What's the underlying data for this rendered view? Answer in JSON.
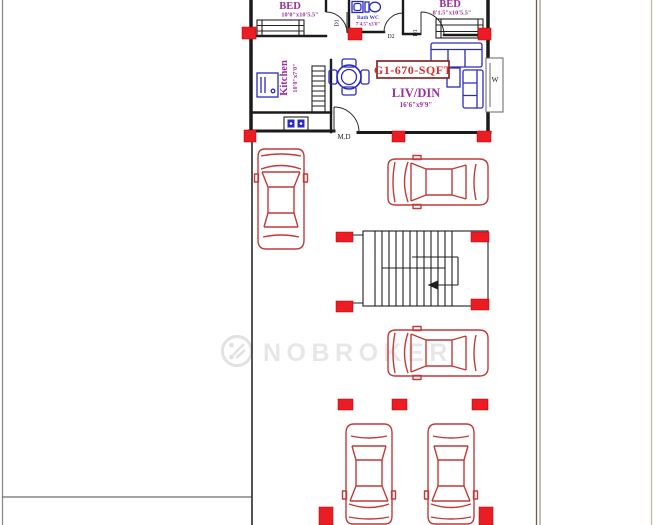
{
  "plan": {
    "unit_area_label": "G1-670-SQFT",
    "rooms": {
      "bed1": {
        "label": "BED",
        "dims": "10'0\"x10'5.5\""
      },
      "bed2": {
        "label": "BED",
        "dims": "8'1.5\"x10'5.5\""
      },
      "bath": {
        "label": "Bath WC",
        "dims": "7'4.5\"x3'0\""
      },
      "kitchen": {
        "label": "Kitchen",
        "dims": "10'0\"x7'0\""
      },
      "living": {
        "label": "LIV/DIN",
        "dims": "16'6\"x9'9\""
      }
    },
    "doors": {
      "main": "M.D",
      "bed1": "D1",
      "bed2": "D1",
      "bath": "D2"
    },
    "window_label": "W"
  },
  "watermark": {
    "brand": "NOBROKER"
  },
  "colors": {
    "wall_black": "#1b1b1b",
    "column_red": "#ec1c24",
    "car_red": "#c23a3a",
    "furniture_blue": "#2a2ac0",
    "room_text_purple": "#9b309b",
    "area_text_red": "#d03030",
    "bath_text_blue": "#3a3ad0",
    "watermark_gray": "#e7e7e7",
    "plot_line_brown": "#6d5d52"
  }
}
